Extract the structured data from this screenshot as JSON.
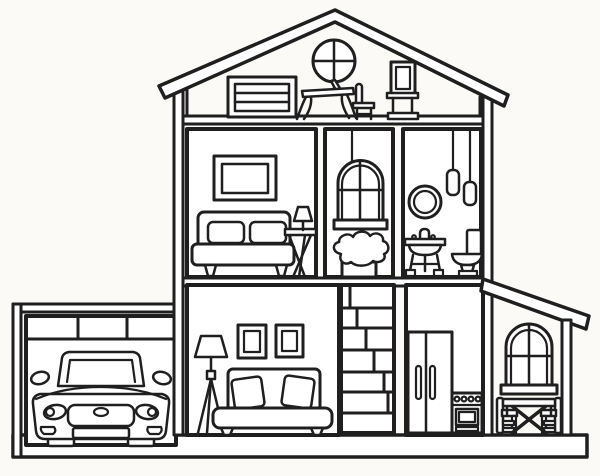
{
  "image": {
    "subject": "Dollhouse cross-section coloring page",
    "style": "black outline line-art on white background"
  },
  "palette": {
    "line": "#1f1f1f",
    "paper": "#ffffff",
    "bg": "#fbfaf7"
  },
  "scene": {
    "floors": [
      {
        "name": "attic",
        "objects": [
          "round-window",
          "dresser",
          "desk",
          "laptop",
          "desk-chair",
          "standing-mirror"
        ]
      },
      {
        "name": "second-floor",
        "rooms": [
          {
            "name": "bedroom",
            "objects": [
              "wall-picture",
              "bed",
              "pillow",
              "pillow",
              "nightstand",
              "table-lamp"
            ]
          },
          {
            "name": "window-nook",
            "objects": [
              "hanging-light",
              "arched-window",
              "shrub"
            ]
          },
          {
            "name": "bathroom",
            "objects": [
              "round-mirror",
              "pendant-light",
              "pendant-light",
              "sink-vanity",
              "toilet"
            ]
          }
        ]
      },
      {
        "name": "ground-floor",
        "rooms": [
          {
            "name": "garage",
            "objects": [
              "garage-header",
              "car"
            ]
          },
          {
            "name": "living-room",
            "objects": [
              "floor-lamp",
              "wall-art",
              "wall-art",
              "sofa"
            ]
          },
          {
            "name": "staircase-column",
            "objects": [
              "brick-pattern"
            ]
          },
          {
            "name": "kitchen",
            "objects": [
              "refrigerator",
              "stove"
            ]
          },
          {
            "name": "dining-porch",
            "objects": [
              "arched-window",
              "dining-table",
              "dining-chair",
              "dining-chair"
            ]
          }
        ]
      }
    ],
    "structure": [
      "pitched-roof",
      "left-wall",
      "right-wall",
      "attic-floor-slab",
      "second-floor-slab",
      "base-slab",
      "porch-roof"
    ]
  }
}
